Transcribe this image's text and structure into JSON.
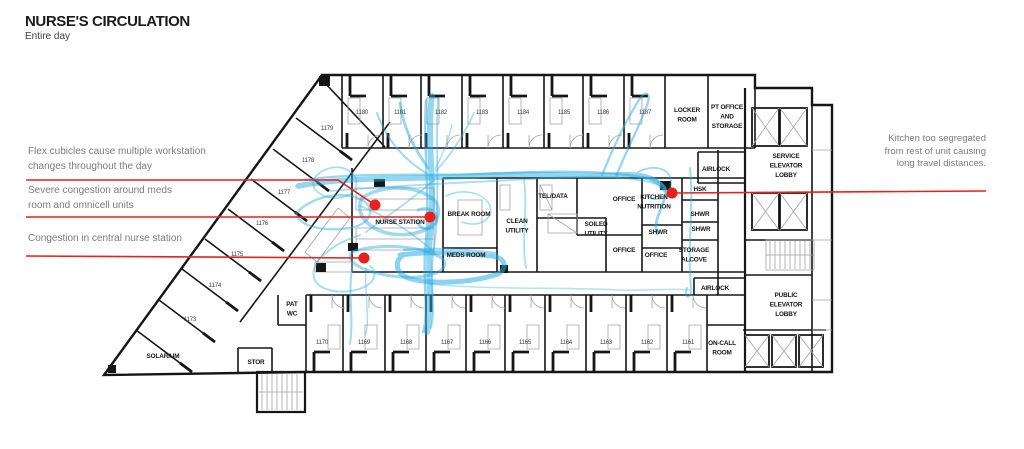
{
  "title": {
    "text": "NURSE'S CIRCULATION",
    "subtitle": "Entire day"
  },
  "colors": {
    "circulation_blue": "#29abe2",
    "annotation_red": "#e8211c",
    "wall_black": "#161616",
    "detail_gray": "#a3a3a3",
    "annotation_text_gray": "#7b7b7b"
  },
  "annotations": [
    {
      "id": "flex-cubicles",
      "lines": [
        "Flex cubicles cause multiple workstation",
        "changes throughout the day"
      ],
      "align": "left",
      "leader": [
        [
          26,
          180
        ],
        [
          338,
          180
        ],
        [
          375,
          205
        ]
      ],
      "dot": [
        375,
        205
      ]
    },
    {
      "id": "meds-congestion",
      "lines": [
        "Severe congestion around meds",
        "room and omnicell units"
      ],
      "align": "left",
      "leader": [
        [
          26,
          217
        ],
        [
          430,
          217
        ]
      ],
      "dot": [
        430,
        217
      ]
    },
    {
      "id": "nurse-station-congestion",
      "lines": [
        "Congestion in central nurse station"
      ],
      "align": "left",
      "leader": [
        [
          26,
          256
        ],
        [
          364,
          258
        ]
      ],
      "dot": [
        364,
        258
      ]
    },
    {
      "id": "kitchen-segregated",
      "lines": [
        "Kitchen too segregated",
        "from rest of unit causing",
        "long travel distances."
      ],
      "align": "right",
      "leader": [
        [
          672,
          193
        ],
        [
          986,
          191
        ]
      ],
      "dot": [
        672,
        193
      ]
    }
  ],
  "plan": {
    "room_numbers": [
      {
        "n": "1180",
        "x": 362,
        "y": 114
      },
      {
        "n": "1181",
        "x": 400,
        "y": 114
      },
      {
        "n": "1182",
        "x": 441,
        "y": 114
      },
      {
        "n": "1183",
        "x": 482,
        "y": 114
      },
      {
        "n": "1184",
        "x": 523,
        "y": 114
      },
      {
        "n": "1185",
        "x": 564,
        "y": 114
      },
      {
        "n": "1186",
        "x": 603,
        "y": 114
      },
      {
        "n": "1187",
        "x": 645,
        "y": 114
      },
      {
        "n": "1179",
        "x": 327,
        "y": 130
      },
      {
        "n": "1178",
        "x": 308,
        "y": 162
      },
      {
        "n": "1177",
        "x": 284,
        "y": 194
      },
      {
        "n": "1176",
        "x": 262,
        "y": 225
      },
      {
        "n": "1175",
        "x": 237,
        "y": 256
      },
      {
        "n": "1174",
        "x": 215,
        "y": 287
      },
      {
        "n": "1173",
        "x": 190,
        "y": 321
      },
      {
        "n": "1170",
        "x": 322,
        "y": 344
      },
      {
        "n": "1169",
        "x": 364,
        "y": 344
      },
      {
        "n": "1168",
        "x": 406,
        "y": 344
      },
      {
        "n": "1167",
        "x": 447,
        "y": 344
      },
      {
        "n": "1166",
        "x": 485,
        "y": 344
      },
      {
        "n": "1165",
        "x": 525,
        "y": 344
      },
      {
        "n": "1164",
        "x": 566,
        "y": 344
      },
      {
        "n": "1163",
        "x": 606,
        "y": 344
      },
      {
        "n": "1162",
        "x": 647,
        "y": 344
      },
      {
        "n": "1161",
        "x": 688,
        "y": 344
      }
    ],
    "room_labels": [
      {
        "lines": [
          "NURSE STATION"
        ],
        "x": 400,
        "y": 224
      },
      {
        "lines": [
          "BREAK ROOM"
        ],
        "x": 469,
        "y": 216
      },
      {
        "lines": [
          "MEDS ROOM"
        ],
        "x": 466,
        "y": 257
      },
      {
        "lines": [
          "CLEAN",
          "UTILITY"
        ],
        "x": 517,
        "y": 223
      },
      {
        "lines": [
          "TEL/DATA"
        ],
        "x": 553,
        "y": 198
      },
      {
        "lines": [
          "SOILED",
          "UTILITY"
        ],
        "x": 596,
        "y": 226
      },
      {
        "lines": [
          "OFFICE"
        ],
        "x": 624,
        "y": 201
      },
      {
        "lines": [
          "KITCHEN",
          "NUTRITION"
        ],
        "x": 654,
        "y": 199
      },
      {
        "lines": [
          "SHWR"
        ],
        "x": 658,
        "y": 234
      },
      {
        "lines": [
          "OFFICE"
        ],
        "x": 624,
        "y": 252
      },
      {
        "lines": [
          "OFFICE"
        ],
        "x": 656,
        "y": 257
      },
      {
        "lines": [
          "STORAGE",
          "ALCOVE"
        ],
        "x": 694,
        "y": 252
      },
      {
        "lines": [
          "HSK"
        ],
        "x": 700,
        "y": 191
      },
      {
        "lines": [
          "SHWR"
        ],
        "x": 700,
        "y": 216
      },
      {
        "lines": [
          "SHWR"
        ],
        "x": 701,
        "y": 231
      },
      {
        "lines": [
          "AIRLOCK"
        ],
        "x": 716,
        "y": 171
      },
      {
        "lines": [
          "AIRLOCK"
        ],
        "x": 715,
        "y": 290
      },
      {
        "lines": [
          "LOCKER",
          "ROOM"
        ],
        "x": 687,
        "y": 112
      },
      {
        "lines": [
          "PT OFFICE",
          "AND",
          "STORAGE"
        ],
        "x": 727,
        "y": 109
      },
      {
        "lines": [
          "SERVICE",
          "ELEVATOR",
          "LOBBY"
        ],
        "x": 786,
        "y": 158
      },
      {
        "lines": [
          "PUBLIC",
          "ELEVATOR",
          "LOBBY"
        ],
        "x": 786,
        "y": 297
      },
      {
        "lines": [
          "ON-CALL",
          "ROOM"
        ],
        "x": 722,
        "y": 345
      },
      {
        "lines": [
          "PAT",
          "WC"
        ],
        "x": 292,
        "y": 306
      },
      {
        "lines": [
          "STOR"
        ],
        "x": 256,
        "y": 364
      },
      {
        "lines": [
          "SOLARIUM"
        ],
        "x": 163,
        "y": 358
      }
    ]
  }
}
